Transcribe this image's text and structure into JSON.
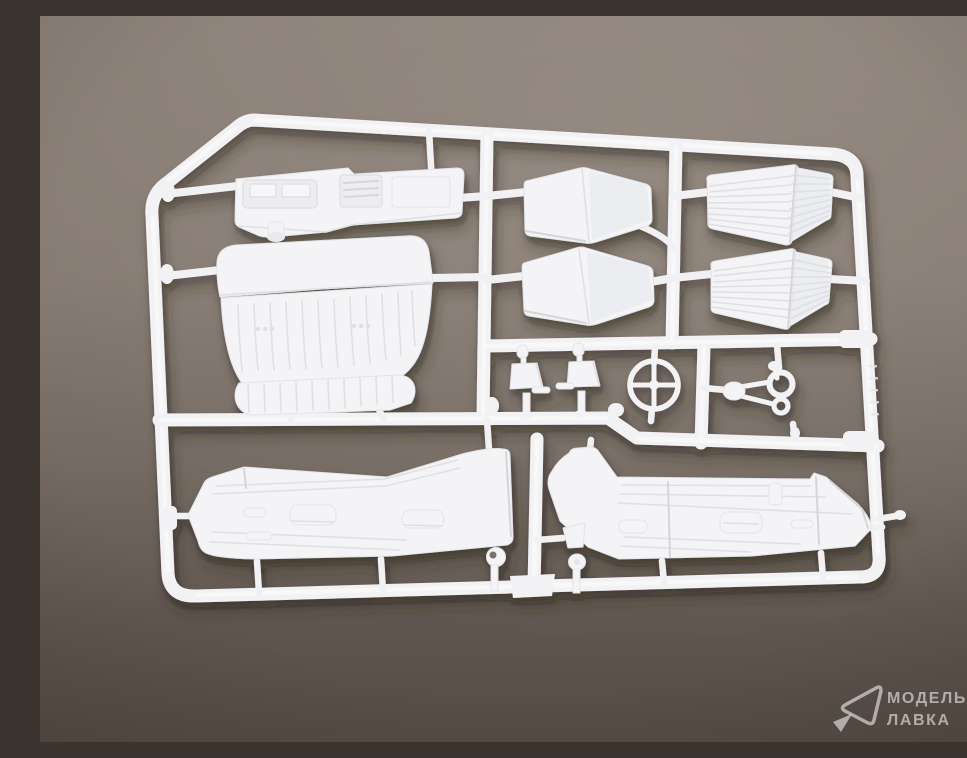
{
  "scene": {
    "type": "product-photo",
    "subject": "white plastic model-kit sprue (parts tree) with car interior parts",
    "background": "plain brown-grey paper, soft light from top, darker vignette toward bottom"
  },
  "colors": {
    "bg_top": "#8b8077",
    "bg_upper": "#877c73",
    "bg_mid": "#746a62",
    "bg_lower": "#5f554e",
    "bg_bottom": "#544b44",
    "plastic": "#f3f3f5",
    "plastic_bright": "#fbfbfc",
    "plastic_shade": "#ecedf0",
    "edge_shade": "#d9dade",
    "cast_shadow": "#2b201a",
    "watermark": "rgba(255,255,255,0.55)"
  },
  "sprue": {
    "material": "white-polystyrene",
    "parts": [
      {
        "id": "frame"
      },
      {
        "id": "dashboard"
      },
      {
        "id": "bench-seat"
      },
      {
        "id": "seat-cushion-front"
      },
      {
        "id": "seat-cushion-rear"
      },
      {
        "id": "seat-backrest-front"
      },
      {
        "id": "seat-backrest-rear"
      },
      {
        "id": "steering-wheel"
      },
      {
        "id": "gear-lever"
      },
      {
        "id": "handbrake-lever"
      },
      {
        "id": "pedal-linkage"
      },
      {
        "id": "door-panel-left"
      },
      {
        "id": "door-panel-right"
      },
      {
        "id": "horn-button"
      },
      {
        "id": "pedal-arm"
      }
    ]
  },
  "watermark": {
    "logo": "pick-arrow-logo",
    "line1": "МОДЕЛЬНАЯ",
    "line2": "ЛАВКА"
  }
}
